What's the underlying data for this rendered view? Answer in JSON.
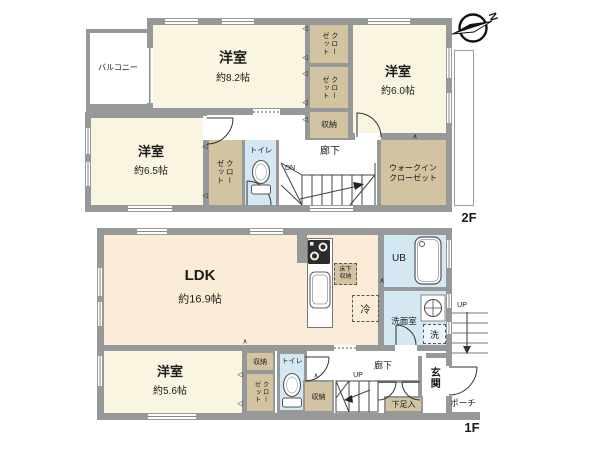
{
  "compass": {
    "north": "N"
  },
  "symbols": {
    "fold_left": "◁",
    "fold_up": "∧"
  },
  "colors": {
    "wall": "#97989a",
    "room": "#faf5e1",
    "ldk": "#fbecd7",
    "closet": "#d2c4a0",
    "wet": "#d3e8f3"
  },
  "floor2": {
    "label": "2F",
    "balcony": "バルコニー",
    "rooms": {
      "main": {
        "name": "洋室",
        "area": "約8.2帖"
      },
      "east": {
        "name": "洋室",
        "area": "約6.0帖"
      },
      "west": {
        "name": "洋室",
        "area": "約6.5帖"
      }
    },
    "closet_top": "クロー\nゼット",
    "closet_bottom": "クロー\nゼット",
    "closet_west": "クロー\nゼット",
    "storage": "収納",
    "toilet": "トイレ",
    "hallway": "廊下",
    "stairs_dn": "DN",
    "walkin_closet": "ウォークイン\nクローゼット"
  },
  "floor1": {
    "label": "1F",
    "ldk": {
      "name": "LDK",
      "area": "約16.9帖"
    },
    "bedroom": {
      "name": "洋室",
      "area": "約5.6帖"
    },
    "underfloor_storage": "床下\n収納",
    "fridge": "冷",
    "unit_bath": "UB",
    "washroom": "洗面室",
    "washer": "洗",
    "storage_small": "収納",
    "closet": "クロー\nゼット",
    "toilet": "トイレ",
    "storage_hall": "収納",
    "stairs_up": "UP",
    "hallway": "廊下",
    "shoe_cabinet": "下足入",
    "entrance": "玄関",
    "porch": "ポーチ",
    "ext_stairs_up": "UP"
  }
}
